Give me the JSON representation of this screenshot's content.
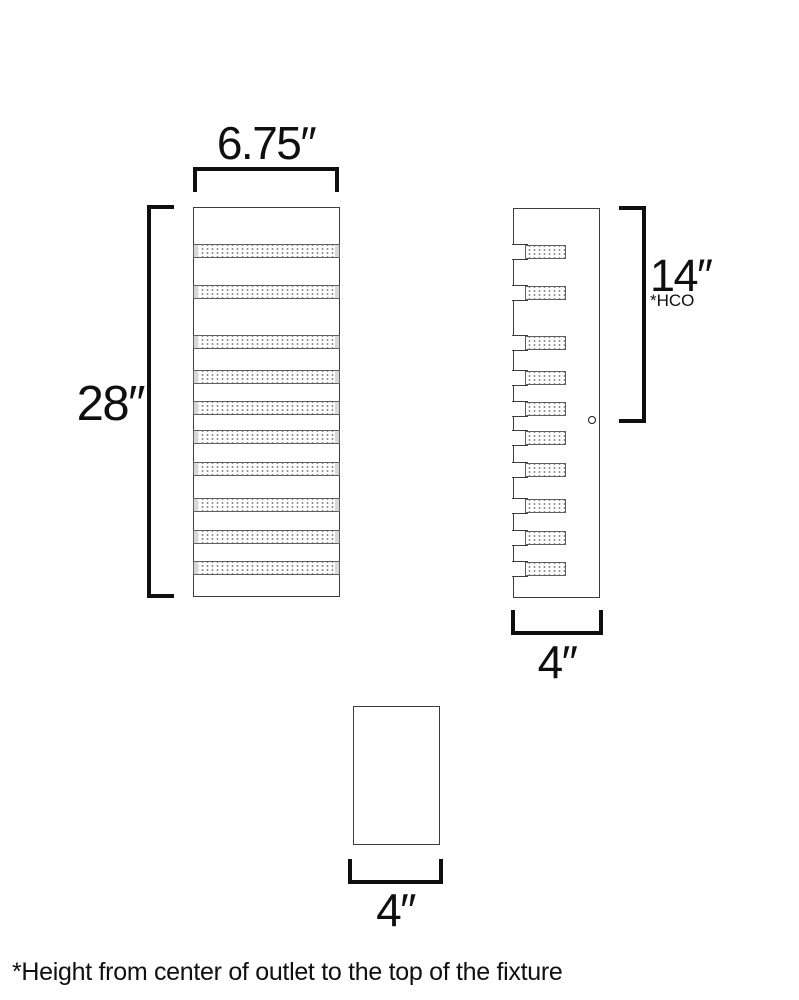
{
  "page": {
    "background": "#ffffff",
    "footnote": "*Height from center of outlet to the top of the fixture"
  },
  "colors": {
    "outline": "#3c3c3c",
    "slat_outline": "#5f5f5f",
    "slat_cap": "#d8d8d8",
    "stipple_dot": "#8d8d8d",
    "dimension_line": "#0f0f0f"
  },
  "views": {
    "front": {
      "name": "front elevation of slatted wall sconce",
      "x": 193,
      "y": 207,
      "width": 147,
      "height": 390,
      "slat_count": 10,
      "slat_height": 14,
      "slat_tops": [
        37,
        78,
        128,
        163,
        194,
        223,
        255,
        291,
        323,
        354
      ]
    },
    "side": {
      "name": "side profile with notched slats",
      "x": 513,
      "y": 208,
      "width": 87,
      "height": 390,
      "notch_depth": 13,
      "slat_width": 41,
      "mount_hole": {
        "cx": 594,
        "cy": 422,
        "r": 3.5
      }
    },
    "bottom": {
      "name": "bottom / plan view",
      "x": 353,
      "y": 706,
      "width": 87,
      "height": 139
    }
  },
  "dimensions": {
    "width": {
      "label": "6.75″"
    },
    "height": {
      "label": "28″"
    },
    "hco": {
      "label": "14″",
      "sublabel": "*HCO"
    },
    "side_width": {
      "label": "4″"
    },
    "bottom_width": {
      "label": "4″"
    }
  }
}
